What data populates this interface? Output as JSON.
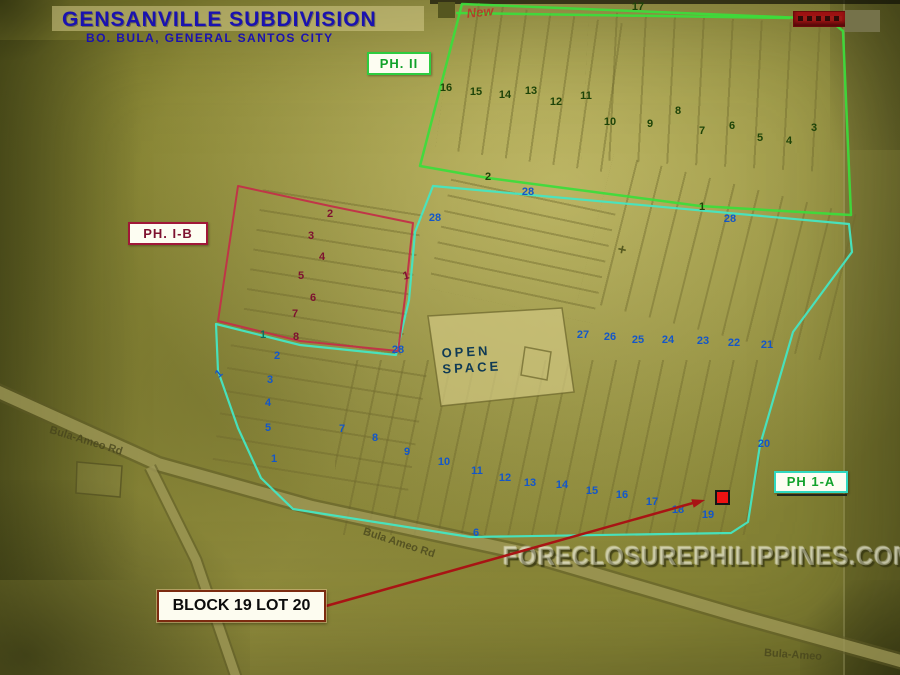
{
  "title": {
    "line1": "GENSANVILLE SUBDIVISION",
    "line2": "BO. BULA, GENERAL SANTOS CITY"
  },
  "phases": {
    "ph2": {
      "label": "PH. II"
    },
    "ph1b": {
      "label": "PH. I-B"
    },
    "ph1a": {
      "label": "PH 1-A"
    }
  },
  "open_space": {
    "line1": "OPEN",
    "line2": "SPACE"
  },
  "callout": {
    "label": "BLOCK 19 LOT 20"
  },
  "watermark": "FORECLOSUREPHILIPPINES.COM",
  "roads": {
    "left": "Bula-Ameo Rd",
    "middle": "Bula Ameo Rd",
    "bottom_right": "Bula-Ameo"
  },
  "annotations": {
    "handwritten_note": "New",
    "plus_mark": "+"
  },
  "colors": {
    "navy": "#1a12b0",
    "green_boundary": "#3bdd3b",
    "cyan_boundary": "#45e6c2",
    "red_boundary": "#c23048",
    "maroon_text": "#7e1130",
    "green_text": "#12a22c",
    "blue_number": "#1457c8",
    "dark_green_number": "#1e4408",
    "teal_number": "#0c6e5e",
    "open_space_text": "#0f3a55",
    "arrow_red": "#a81414",
    "marker_red": "#ee1212",
    "callout_border": "#7c2b10"
  },
  "lot_numbers": [
    {
      "t": "17",
      "x": 638,
      "y": 7,
      "c": "g",
      "g": "ph2"
    },
    {
      "t": "16",
      "x": 446,
      "y": 88,
      "c": "g",
      "g": "ph2"
    },
    {
      "t": "15",
      "x": 476,
      "y": 92,
      "c": "g",
      "g": "ph2"
    },
    {
      "t": "14",
      "x": 505,
      "y": 95,
      "c": "g",
      "g": "ph2"
    },
    {
      "t": "13",
      "x": 531,
      "y": 91,
      "c": "g",
      "g": "ph2"
    },
    {
      "t": "12",
      "x": 556,
      "y": 102,
      "c": "g",
      "g": "ph2"
    },
    {
      "t": "11",
      "x": 586,
      "y": 96,
      "c": "g",
      "g": "ph2"
    },
    {
      "t": "10",
      "x": 610,
      "y": 122,
      "c": "g",
      "g": "ph2"
    },
    {
      "t": "9",
      "x": 650,
      "y": 124,
      "c": "g",
      "g": "ph2"
    },
    {
      "t": "8",
      "x": 678,
      "y": 111,
      "c": "g",
      "g": "ph2"
    },
    {
      "t": "7",
      "x": 702,
      "y": 131,
      "c": "g",
      "g": "ph2"
    },
    {
      "t": "6",
      "x": 732,
      "y": 126,
      "c": "g",
      "g": "ph2"
    },
    {
      "t": "5",
      "x": 760,
      "y": 138,
      "c": "g",
      "g": "ph2"
    },
    {
      "t": "4",
      "x": 789,
      "y": 141,
      "c": "g",
      "g": "ph2"
    },
    {
      "t": "3",
      "x": 814,
      "y": 128,
      "c": "g",
      "g": "ph2"
    },
    {
      "t": "2",
      "x": 488,
      "y": 177,
      "c": "g",
      "g": "ph2"
    },
    {
      "t": "1",
      "x": 702,
      "y": 207,
      "c": "g",
      "g": "ph2"
    },
    {
      "t": "2",
      "x": 330,
      "y": 214,
      "c": "m",
      "g": "ph1b"
    },
    {
      "t": "3",
      "x": 311,
      "y": 236,
      "c": "m",
      "g": "ph1b"
    },
    {
      "t": "4",
      "x": 322,
      "y": 257,
      "c": "m",
      "g": "ph1b"
    },
    {
      "t": "5",
      "x": 301,
      "y": 276,
      "c": "m",
      "g": "ph1b"
    },
    {
      "t": "6",
      "x": 313,
      "y": 298,
      "c": "m",
      "g": "ph1b"
    },
    {
      "t": "7",
      "x": 295,
      "y": 314,
      "c": "m",
      "g": "ph1b"
    },
    {
      "t": "8",
      "x": 296,
      "y": 337,
      "c": "m",
      "g": "ph1b"
    },
    {
      "t": "1",
      "x": 406,
      "y": 276,
      "c": "m",
      "g": "ph1b",
      "r": -15
    },
    {
      "t": "28",
      "x": 528,
      "y": 192,
      "c": "b",
      "g": "boundary"
    },
    {
      "t": "28",
      "x": 730,
      "y": 219,
      "c": "b",
      "g": "boundary"
    },
    {
      "t": "28",
      "x": 435,
      "y": 218,
      "c": "b",
      "g": "boundary"
    },
    {
      "t": "28",
      "x": 398,
      "y": 350,
      "c": "b",
      "g": "boundary"
    },
    {
      "t": "1",
      "x": 219,
      "y": 374,
      "c": "b",
      "g": "ph1a",
      "r": -40
    },
    {
      "t": "1",
      "x": 263,
      "y": 335,
      "c": "t",
      "g": "ph1a"
    },
    {
      "t": "2",
      "x": 277,
      "y": 356,
      "c": "b",
      "g": "ph1a"
    },
    {
      "t": "3",
      "x": 270,
      "y": 380,
      "c": "b",
      "g": "ph1a"
    },
    {
      "t": "4",
      "x": 268,
      "y": 403,
      "c": "b",
      "g": "ph1a"
    },
    {
      "t": "5",
      "x": 268,
      "y": 428,
      "c": "b",
      "g": "ph1a"
    },
    {
      "t": "1",
      "x": 274,
      "y": 459,
      "c": "b",
      "g": "ph1a"
    },
    {
      "t": "6",
      "x": 476,
      "y": 533,
      "c": "b",
      "g": "ph1a"
    },
    {
      "t": "7",
      "x": 342,
      "y": 429,
      "c": "b",
      "g": "ph1a"
    },
    {
      "t": "8",
      "x": 375,
      "y": 438,
      "c": "b",
      "g": "ph1a"
    },
    {
      "t": "9",
      "x": 407,
      "y": 452,
      "c": "b",
      "g": "ph1a"
    },
    {
      "t": "10",
      "x": 444,
      "y": 462,
      "c": "b",
      "g": "ph1a"
    },
    {
      "t": "11",
      "x": 477,
      "y": 471,
      "c": "b",
      "g": "ph1a"
    },
    {
      "t": "12",
      "x": 505,
      "y": 478,
      "c": "b",
      "g": "ph1a"
    },
    {
      "t": "13",
      "x": 530,
      "y": 483,
      "c": "b",
      "g": "ph1a"
    },
    {
      "t": "14",
      "x": 562,
      "y": 485,
      "c": "b",
      "g": "ph1a"
    },
    {
      "t": "15",
      "x": 592,
      "y": 491,
      "c": "b",
      "g": "ph1a"
    },
    {
      "t": "16",
      "x": 622,
      "y": 495,
      "c": "b",
      "g": "ph1a"
    },
    {
      "t": "17",
      "x": 652,
      "y": 502,
      "c": "b",
      "g": "ph1a"
    },
    {
      "t": "18",
      "x": 678,
      "y": 510,
      "c": "b",
      "g": "ph1a"
    },
    {
      "t": "19",
      "x": 708,
      "y": 515,
      "c": "b",
      "g": "ph1a"
    },
    {
      "t": "20",
      "x": 764,
      "y": 444,
      "c": "b",
      "g": "ph1a"
    },
    {
      "t": "21",
      "x": 767,
      "y": 345,
      "c": "b",
      "g": "ph1a"
    },
    {
      "t": "22",
      "x": 734,
      "y": 343,
      "c": "b",
      "g": "ph1a"
    },
    {
      "t": "23",
      "x": 703,
      "y": 341,
      "c": "b",
      "g": "ph1a"
    },
    {
      "t": "24",
      "x": 668,
      "y": 340,
      "c": "b",
      "g": "ph1a"
    },
    {
      "t": "25",
      "x": 638,
      "y": 340,
      "c": "b",
      "g": "ph1a"
    },
    {
      "t": "26",
      "x": 610,
      "y": 337,
      "c": "b",
      "g": "ph1a"
    },
    {
      "t": "27",
      "x": 583,
      "y": 335,
      "c": "b",
      "g": "ph1a"
    }
  ]
}
